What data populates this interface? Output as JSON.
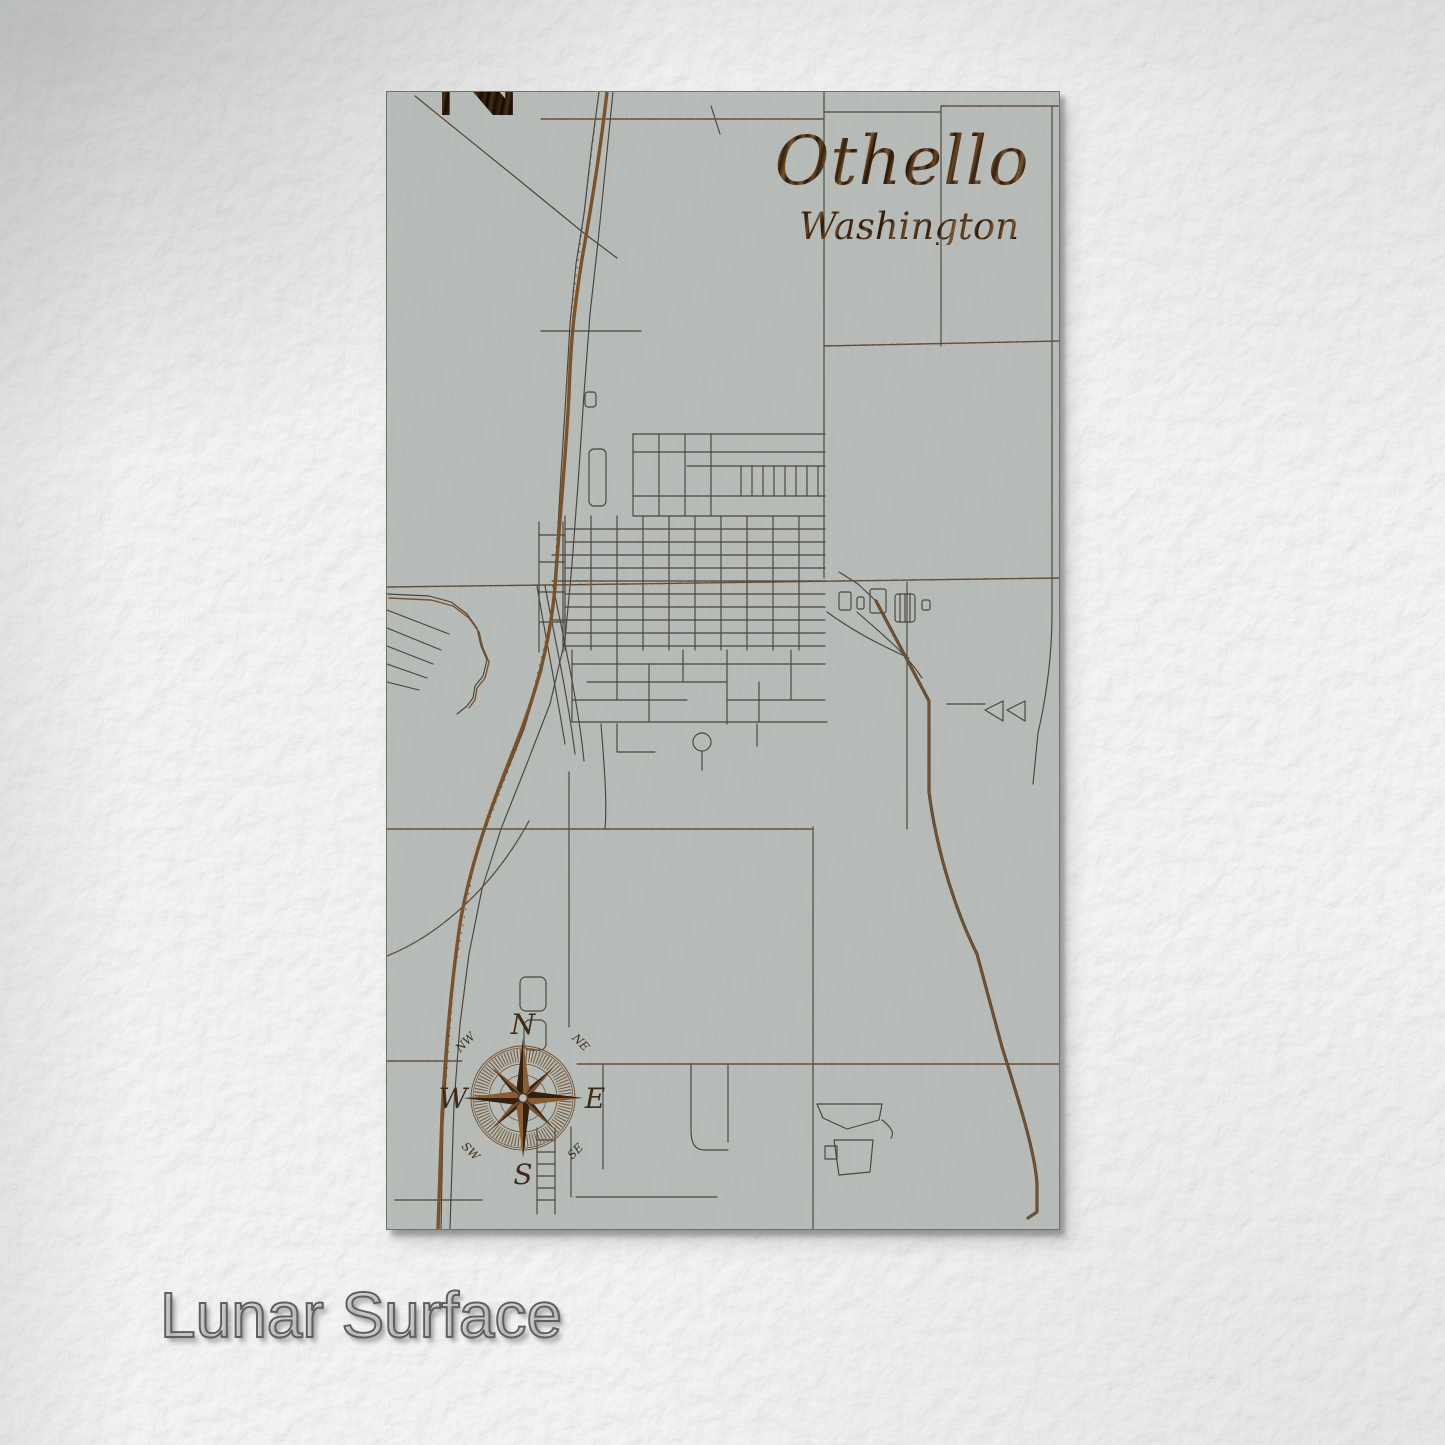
{
  "product": {
    "finish_label": "Lunar Surface"
  },
  "map": {
    "title": "Othello",
    "subtitle": "Washington",
    "partial_letter": "N",
    "compass": {
      "n": "N",
      "e": "E",
      "s": "S",
      "w": "W",
      "ne": "NE",
      "nw": "NW",
      "se": "SE",
      "sw": "SW"
    }
  },
  "colors": {
    "paper": "#f4f4f3",
    "panel_wood": "#b6bbb8",
    "engrave_dark": "#4a443c",
    "engrave_brown": "#7b5229",
    "label_outline": "#5d6062"
  }
}
